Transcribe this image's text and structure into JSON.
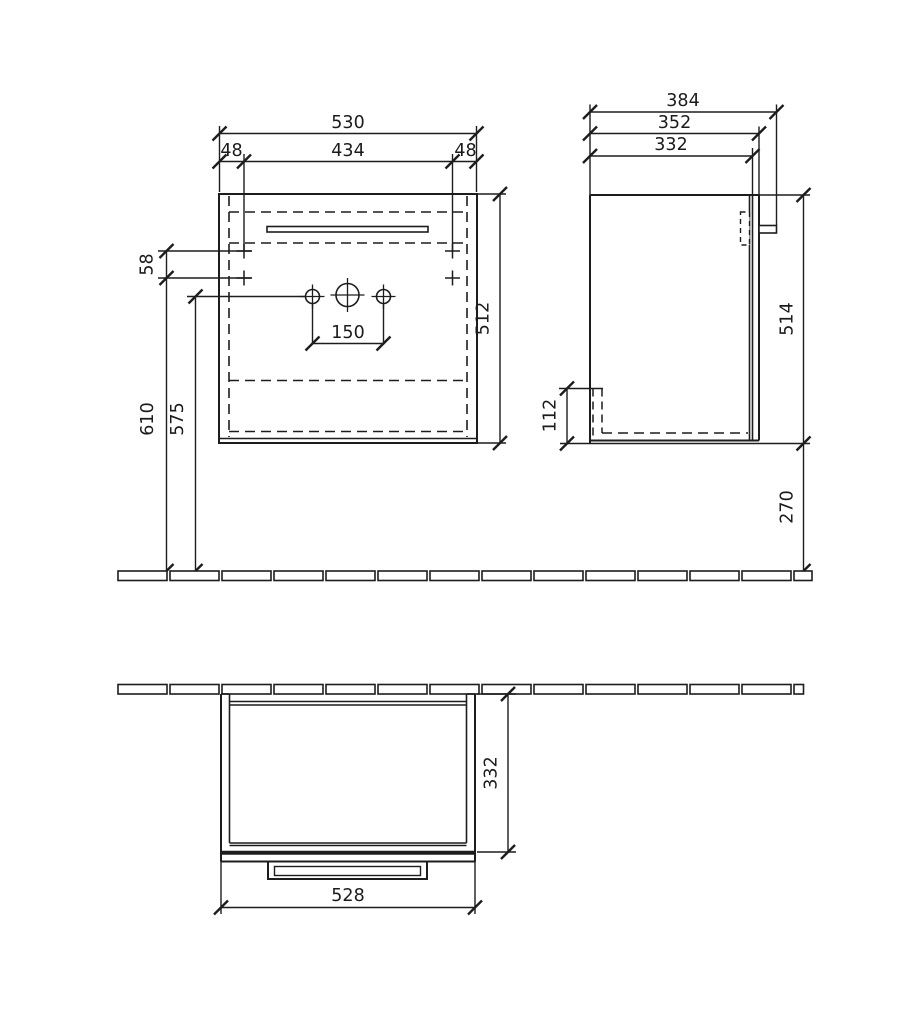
{
  "drawing": {
    "front_view": {
      "overall_width": "530",
      "left_hole_offset": "48",
      "hole_span": "434",
      "right_hole_offset": "48",
      "hole_row_spacing": "58",
      "height": "512",
      "tap_hole_spacing": "150",
      "top_row_to_rail": "610",
      "tap_row_to_rail": "575"
    },
    "side_view": {
      "overall_depth": "384",
      "depth_with_door": "352",
      "body_depth": "332",
      "height": "514",
      "base_recess_height": "112",
      "bottom_to_rail": "270"
    },
    "top_view": {
      "body_depth": "332",
      "body_width": "528"
    }
  }
}
